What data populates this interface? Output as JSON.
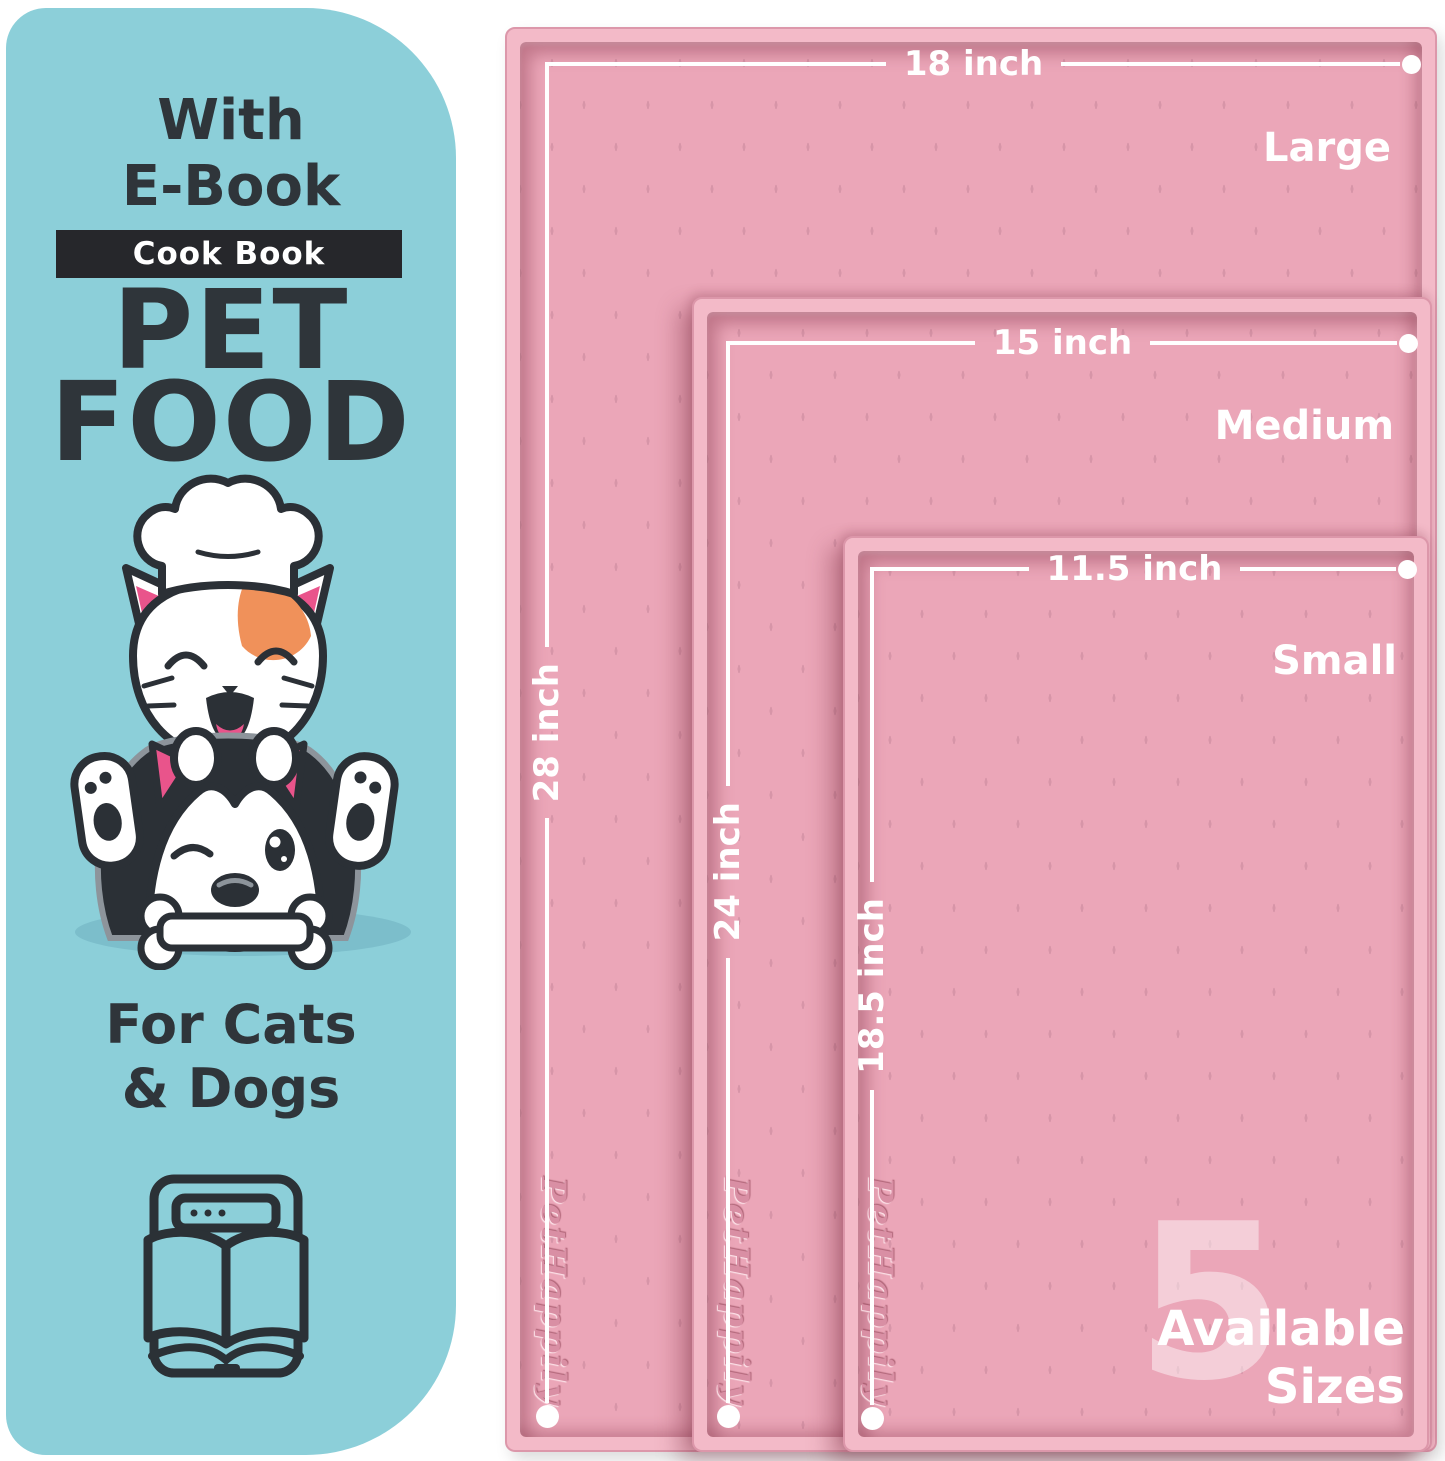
{
  "left_card": {
    "bg_color": "#8ccfd9",
    "text_color": "#2f353a",
    "line1": "With",
    "line2": "E-Book",
    "banner": {
      "label": "Cook Book",
      "bg": "#26272b",
      "text_color": "#ffffff"
    },
    "title_line1": "PET",
    "title_line2": "FOOD",
    "audience_line1": "For Cats",
    "audience_line2": "& Dogs",
    "icons": [
      "chef-hat-icon",
      "cat-face",
      "dog-face",
      "bone-icon",
      "ebook-tablet-open-book-icon"
    ]
  },
  "mats": [
    {
      "name": "Large",
      "width_label": "18 inch",
      "height_label": "28 inch",
      "brand": "PetHappily"
    },
    {
      "name": "Medium",
      "width_label": "15 inch",
      "height_label": "24 inch",
      "brand": "PetHappily"
    },
    {
      "name": "Small",
      "width_label": "11.5 inch",
      "height_label": "18.5 inch",
      "brand": "PetHappily"
    }
  ],
  "sizes_badge": {
    "number": "5",
    "line1": "Available",
    "line2": "Sizes"
  },
  "colors": {
    "mat_rim": "#f3bac8",
    "mat_surface": "#eba6b8",
    "dimension_line": "#ffffff",
    "accent_orange": "#f0915a",
    "accent_pink": "#e9548b",
    "outline_dark": "#2b3036",
    "shadow_teal": "#7cbecb"
  }
}
